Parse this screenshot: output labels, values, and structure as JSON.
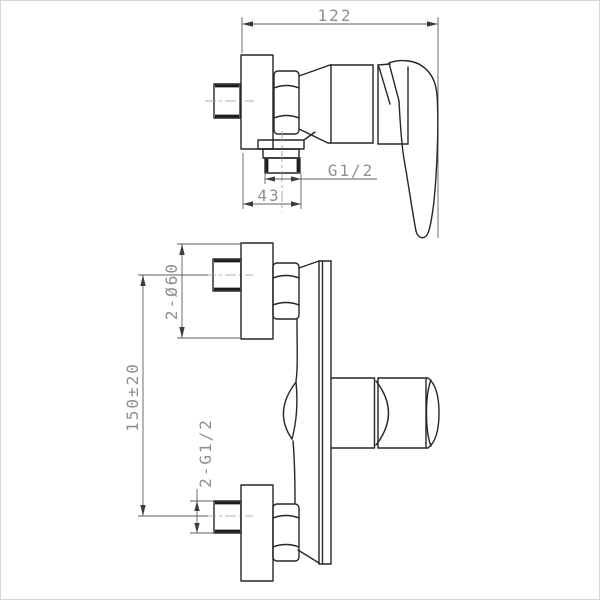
{
  "drawing": {
    "type": "technical-drawing",
    "subject": "wall-mounted shower mixer valve, two orthographic views with dimensions",
    "colors": {
      "outline": "#262626",
      "dimension_line": "#5d5d5d",
      "centerline": "#989898",
      "dimension_text": "#8f8f8f",
      "background": "#ffffff",
      "frame": "#d6d6d6"
    },
    "side_view": {
      "name": "side view",
      "dims": {
        "overall_depth": "122",
        "outlet_thread": "G1/2",
        "outlet_offset": "43"
      }
    },
    "front_view": {
      "name": "front view",
      "dims": {
        "flange_diameter": "2-Ø60",
        "inlet_spacing": "150±20",
        "inlet_thread": "2-G1/2"
      }
    }
  }
}
